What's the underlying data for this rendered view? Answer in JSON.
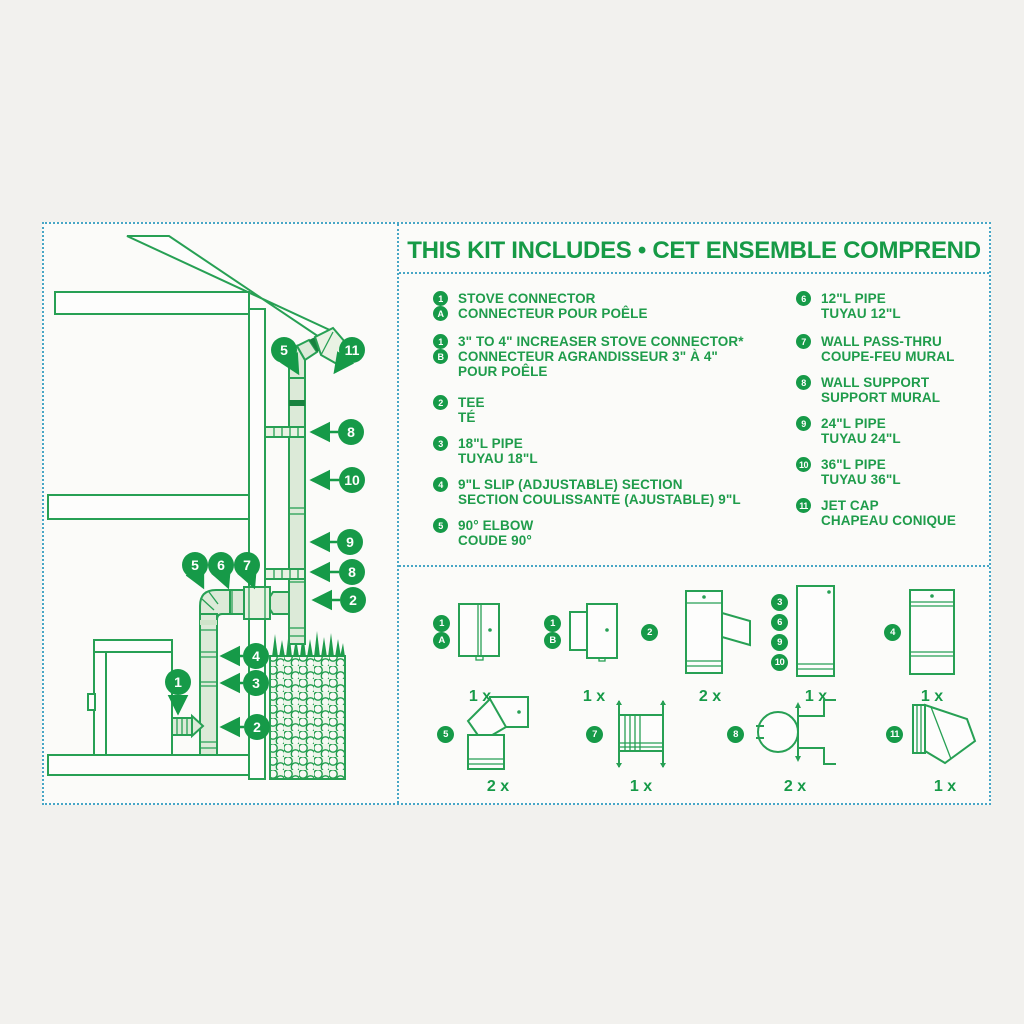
{
  "colors": {
    "green": "#169A48",
    "line_green": "#27A054",
    "dot_border": "#47A6C6",
    "pipe_fill": "#DCEAD8",
    "background": "#F2F1EE",
    "panel": "#FBFBF9"
  },
  "header": {
    "title": "THIS KIT INCLUDES • CET ENSEMBLE COMPREND"
  },
  "list": {
    "left": [
      {
        "badges": [
          "1",
          "A"
        ],
        "lines": [
          "STOVE CONNECTOR",
          "CONNECTEUR POUR POÊLE"
        ]
      },
      {
        "badges": [
          "1",
          "B"
        ],
        "lines": [
          "3\" TO 4\" INCREASER STOVE CONNECTOR*",
          "CONNECTEUR AGRANDISSEUR 3\" À 4\"",
          "POUR POÊLE"
        ]
      },
      {
        "badges": [
          "2"
        ],
        "lines": [
          "TEE",
          "TÉ"
        ]
      },
      {
        "badges": [
          "3"
        ],
        "lines": [
          "18\"L PIPE",
          "TUYAU 18\"L"
        ]
      },
      {
        "badges": [
          "4"
        ],
        "lines": [
          "9\"L SLIP (ADJUSTABLE) SECTION",
          "SECTION COULISSANTE (AJUSTABLE) 9\"L"
        ]
      },
      {
        "badges": [
          "5"
        ],
        "lines": [
          "90° ELBOW",
          "COUDE 90°"
        ]
      }
    ],
    "right": [
      {
        "badges": [
          "6"
        ],
        "lines": [
          "12\"L PIPE",
          "TUYAU 12\"L"
        ]
      },
      {
        "badges": [
          "7"
        ],
        "lines": [
          "WALL PASS-THRU",
          "COUPE-FEU MURAL"
        ]
      },
      {
        "badges": [
          "8"
        ],
        "lines": [
          "WALL SUPPORT",
          "SUPPORT MURAL"
        ]
      },
      {
        "badges": [
          "9"
        ],
        "lines": [
          "24\"L PIPE",
          "TUYAU 24\"L"
        ]
      },
      {
        "badges": [
          "10"
        ],
        "lines": [
          "36\"L PIPE",
          "TUYAU 36\"L"
        ]
      },
      {
        "badges": [
          "11"
        ],
        "lines": [
          "JET CAP",
          "CHAPEAU CONIQUE"
        ]
      }
    ]
  },
  "grid": {
    "row1": [
      {
        "badges": [
          "1",
          "A"
        ],
        "qty": "1 x"
      },
      {
        "badges": [
          "1",
          "B"
        ],
        "qty": "1 x"
      },
      {
        "badges": [
          "2"
        ],
        "qty": "2 x"
      },
      {
        "badges": [
          "3",
          "6",
          "9",
          "10"
        ],
        "qty": "1 x"
      },
      {
        "badges": [
          "4"
        ],
        "qty": "1 x"
      }
    ],
    "row2": [
      {
        "badges": [
          "5"
        ],
        "qty": "2 x"
      },
      {
        "badges": [
          "7"
        ],
        "qty": "1 x"
      },
      {
        "badges": [
          "8"
        ],
        "qty": "2 x"
      },
      {
        "badges": [
          "11"
        ],
        "qty": "1 x"
      }
    ]
  },
  "callouts": [
    "5",
    "11",
    "8",
    "10",
    "9",
    "8",
    "2",
    "5",
    "6",
    "7",
    "4",
    "3",
    "2",
    "1"
  ]
}
